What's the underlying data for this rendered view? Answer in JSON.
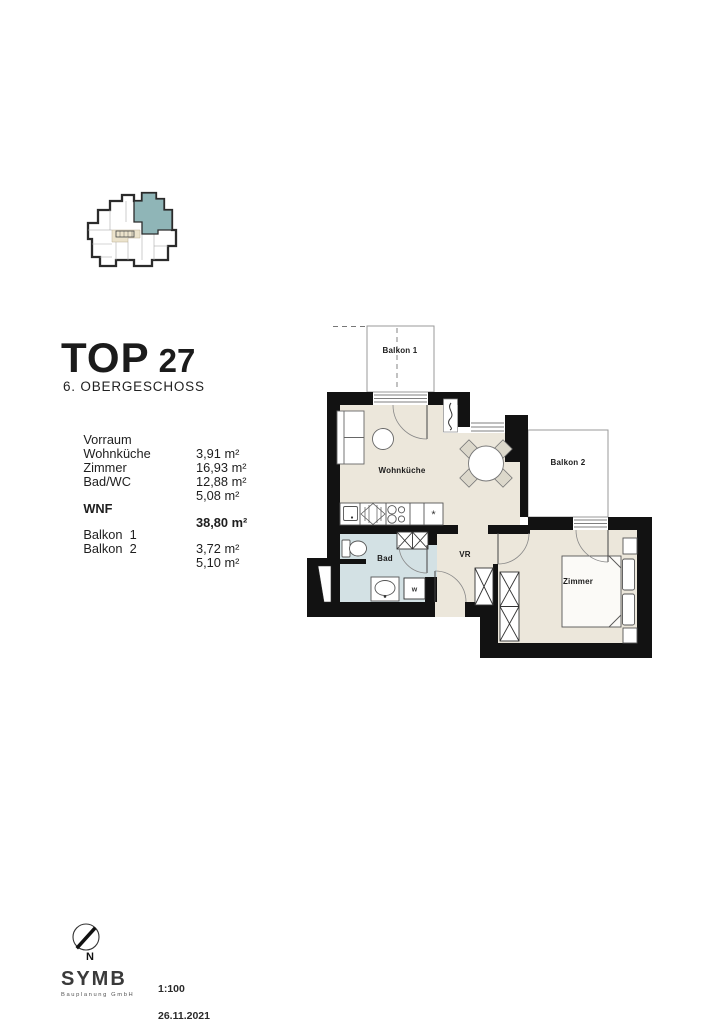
{
  "colors": {
    "wall": "#121212",
    "floor": "#ece7db",
    "bath_floor": "#d3e1e4",
    "unit_highlight": "#8fb5b7",
    "corridor": "#ece3cc",
    "balcony_outline": "#9a9a9a"
  },
  "title": {
    "main": "TOP",
    "number": "27",
    "floor": "6. OBERGESCHOSS"
  },
  "areas": {
    "rooms": [
      {
        "label": "Vorraum",
        "value": "3,91 m²"
      },
      {
        "label": "Wohnküche",
        "value": "16,93 m²"
      },
      {
        "label": "Zimmer",
        "value": "12,88 m²"
      },
      {
        "label": "Bad/WC",
        "value": "5,08 m²"
      }
    ],
    "total": {
      "label": "WNF",
      "value": "38,80 m²"
    },
    "balconies": [
      {
        "label": "Balkon  1",
        "value": "3,72 m²"
      },
      {
        "label": "Balkon  2",
        "value": "5,10 m²"
      }
    ]
  },
  "plan": {
    "labels": {
      "balkon1": "Balkon 1",
      "balkon2": "Balkon 2",
      "wohnkueche": "Wohnküche",
      "bad": "Bad",
      "vr": "VR",
      "zimmer": "Zimmer"
    },
    "fridge_symbol": "*",
    "washer_symbol": "w"
  },
  "footer": {
    "north": "N",
    "logo": "SYMB",
    "logo_sub": "Bauplanung GmbH",
    "scale": "1:100",
    "date": "26.11.2021"
  }
}
